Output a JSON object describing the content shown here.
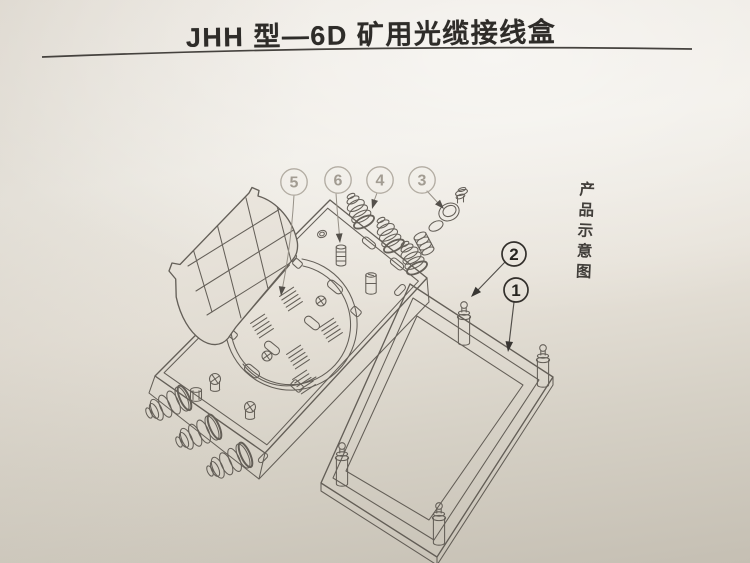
{
  "doc": {
    "title": "JHH 型—6D 矿用光缆接线盒",
    "side_label": "产品示意图"
  },
  "callouts": [
    {
      "label": "1",
      "style": "dark",
      "target": "base-plate"
    },
    {
      "label": "2",
      "style": "dark",
      "target": "corner-stud"
    },
    {
      "label": "3",
      "style": "faded",
      "target": "gland-seal-parts"
    },
    {
      "label": "4",
      "style": "faded",
      "target": "cable-gland-nut"
    },
    {
      "label": "5",
      "style": "faded",
      "target": "coil-spring"
    },
    {
      "label": "6",
      "style": "faded",
      "target": "ribbed-post"
    }
  ],
  "colors": {
    "paper_top": "#efece5",
    "paper_bottom": "#c5bfb3",
    "line_art": "#5a554e",
    "callout_dark": "#26241f",
    "callout_faded": "#a29c92"
  }
}
